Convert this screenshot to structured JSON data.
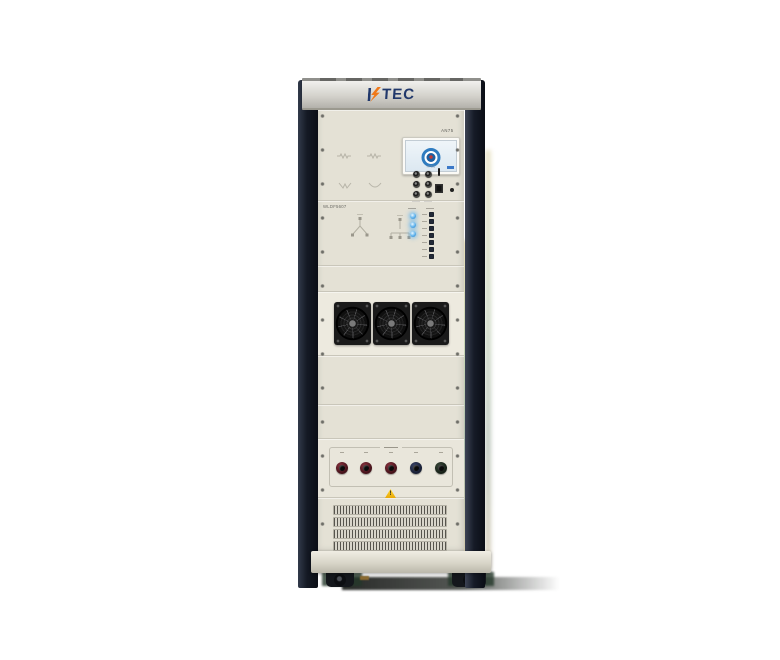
{
  "scene": {
    "background": "#ffffff",
    "description": "product photo of HTEC test equipment rack cabinet"
  },
  "brand": {
    "name": "HTEC",
    "mark": "TEC",
    "lightning_color": "#f07818",
    "navy": "#21386b"
  },
  "display_panel": {
    "tag": "AN75",
    "mini_connector_count": 6
  },
  "screen": {
    "caption": "HTEC",
    "logo_ring_color": "#2f7cc0"
  },
  "wiring_panel": {
    "model": "WLDF5607",
    "star_diagram_count": 2
  },
  "indicators": {
    "blue_led_count": 3,
    "blue_led_color": "#5ab0ec",
    "status_led_count": 7
  },
  "fans": {
    "count": 3
  },
  "terminals": {
    "count": 5,
    "colors": [
      "dark-red",
      "dark-red",
      "dark-red",
      "navy",
      "dark-green"
    ]
  },
  "warning": {
    "symbol": "!",
    "color": "#f0b80c"
  },
  "grille": {
    "row_count": 4
  }
}
